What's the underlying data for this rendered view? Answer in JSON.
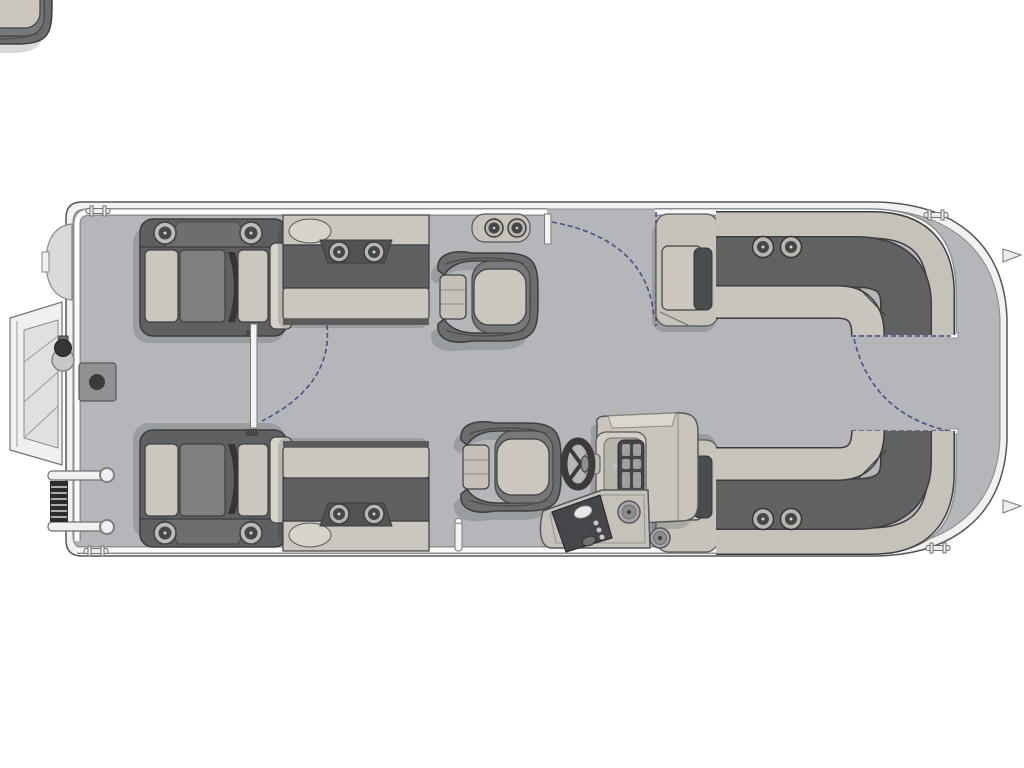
{
  "page": {
    "background": "#ffffff"
  },
  "palette": {
    "page_bg": "#ffffff",
    "deck": "#b4b6b9",
    "hull_trim": "#f0f1f2",
    "outline": "#55575a",
    "seat_dark": "#5f6062",
    "seat_mid": "#7f8082",
    "cushion_light": "#cbc6be",
    "cushion_lighter": "#d7d3cb",
    "console": "#c9c5bc",
    "panel_dark": "#454649",
    "gate_arc": "#4a4f8c",
    "shadow": "rgba(40,42,48,0.18)"
  },
  "floorplan": {
    "type": "pontoon-boat-floorplan-top-view",
    "components": [
      "bow-boarding-platform",
      "bow-ladder",
      "bow-nav-light",
      "deck-plate",
      "port-bow-lounger",
      "starboard-bow-lounger",
      "port-forward-bench",
      "starboard-forward-bench",
      "bow-walkthrough-gate",
      "port-side-gate",
      "stern-gate",
      "cupholder-pod",
      "pedestal-chair",
      "helm-chair",
      "helm-console",
      "steering-wheel",
      "entry-step-panel",
      "stern-l-bench-port",
      "stern-l-bench-starboard",
      "stern-deck",
      "mooring-cleats",
      "motor-mount-fins"
    ],
    "counts": {
      "bow_loungers": 2,
      "forward_benches": 2,
      "pedestal_chairs": 2,
      "stern_l_benches": 2,
      "gates": 3,
      "cup_holders": 14,
      "speakers": 2,
      "cleats": 4
    }
  }
}
